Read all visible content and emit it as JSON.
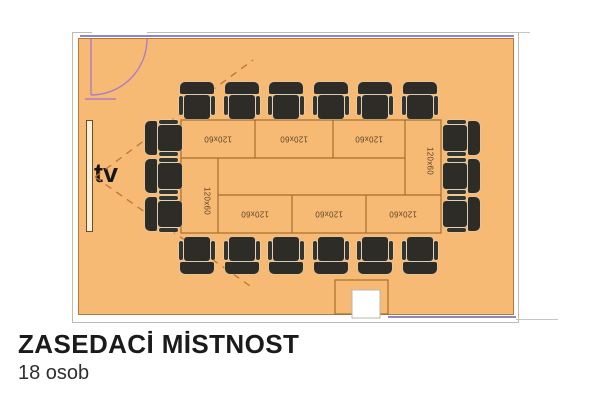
{
  "caption": {
    "heading": "ZASEDACİ MİSTNOST",
    "subtitle": "18 osob"
  },
  "room": {
    "tv_label": "tv",
    "capacity": 18,
    "seating": {
      "top": 6,
      "bottom": 6,
      "left": 3,
      "right": 3
    },
    "table_modules": [
      {
        "position": "top-1",
        "label": "120x60"
      },
      {
        "position": "top-2",
        "label": "120x60"
      },
      {
        "position": "top-3",
        "label": "120x60"
      },
      {
        "position": "end-right",
        "label": "120x60"
      },
      {
        "position": "bottom-1",
        "label": "120x60"
      },
      {
        "position": "bottom-2",
        "label": "120x60"
      },
      {
        "position": "bottom-3",
        "label": "120x60"
      },
      {
        "position": "end-left",
        "label": "120x60"
      }
    ]
  },
  "colors": {
    "floor": "#f6ba74",
    "wall_brown": "#b5793c",
    "wall_purple": "#9086c4",
    "door_arc": "#b07cc4",
    "table_line": "#a56d2f",
    "chair": "#2e2c27",
    "sight_dash": "#c2742e"
  }
}
